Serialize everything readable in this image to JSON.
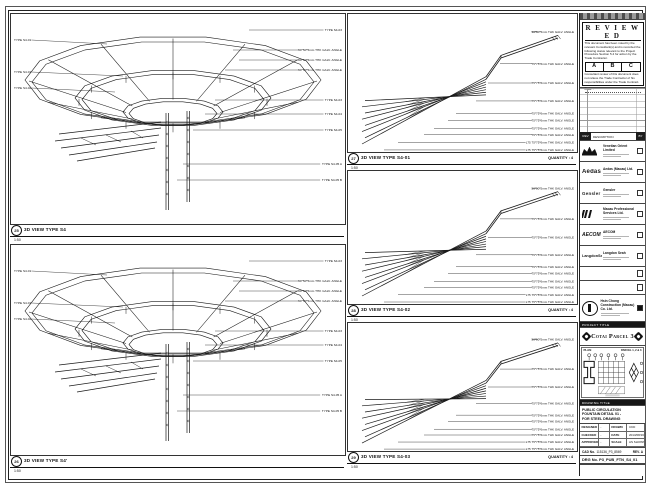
{
  "panels": {
    "left_top": {
      "num": "25",
      "title": "3D VIEW TYPE S4",
      "scale": "1:50",
      "labels_left": [
        "TYPE S4-01",
        "TYPE S4-01",
        "TYPE S4-02"
      ],
      "labels_right": [
        "TYPE S4-03",
        "50*50*5mm THK GALV. ANGLE",
        "50*50*5mm THK GALV. ANGLE",
        "50*50*5mm THK GALV. ANGLE",
        "TYPE S4-03",
        "TYPE S4-04",
        "TYPE S4-05",
        "TYPE S4-05 A",
        "TYPE S4-05 B"
      ]
    },
    "left_bottom": {
      "num": "26",
      "title": "3D VIEW TYPE S4'",
      "scale": "1:50",
      "labels_left": [
        "TYPE S4-01",
        "TYPE S4-01",
        "TYPE S4-02"
      ],
      "labels_right": [
        "TYPE S4-03",
        "50*50*5mm THK GALV. ANGLE",
        "50*50*5mm THK GALV. ANGLE",
        "50*50*5mm THK GALV. ANGLE",
        "TYPE S4-03",
        "TYPE S4-04",
        "TYPE S4-05",
        "TYPE S4-05 A",
        "TYPE S4-05 B"
      ]
    },
    "mid_top": {
      "num": "27",
      "title": "3D VIEW TYPE S4-01",
      "scale": "1:50",
      "quantity": "QUANTITY : 4",
      "labels": [
        "50*50*5mm THK GALV. ANGLE",
        "75*75*6mm THK GALV. ANGLE",
        "75*75*6mm THK GALV. ANGLE",
        "75*75*6mm THK GALV. ANGLE",
        "75*75*6mm THK GALV. ANGLE",
        "75*75*6mm THK GALV. ANGLE",
        "75*75*6mm THK GALV. ANGLE",
        "75*75*6mm THK GALV. ANGLE",
        "L75 75*75*6mm THK GALV. ANGLE",
        "L75 75*75*6mm THK GALV. ANGLE"
      ]
    },
    "mid_mid": {
      "num": "28",
      "title": "3D VIEW TYPE S4-02",
      "scale": "1:50",
      "quantity": "QUANTITY : 4",
      "labels": [
        "50*50*5mm THK GALV. ANGLE",
        "75*75*6mm THK GALV. ANGLE",
        "75*75*6mm THK GALV. ANGLE",
        "75*75*6mm THK GALV. ANGLE",
        "75*75*6mm THK GALV. ANGLE",
        "75*75*6mm THK GALV. ANGLE",
        "75*75*6mm THK GALV. ANGLE",
        "75*75*6mm THK GALV. ANGLE",
        "L75 75*75*6mm THK GALV. ANGLE",
        "L75 75*75*6mm THK GALV. ANGLE"
      ]
    },
    "mid_bottom": {
      "num": "29",
      "title": "3D VIEW TYPE S4-03",
      "scale": "1:50",
      "quantity": "QUANTITY : 4",
      "labels": [
        "50*50*5mm THK GALV. ANGLE",
        "75*75*6mm THK GALV. ANGLE",
        "75*75*6mm THK GALV. ANGLE",
        "75*75*6mm THK GALV. ANGLE",
        "75*75*6mm THK GALV. ANGLE",
        "75*75*6mm THK GALV. ANGLE",
        "75*75*6mm THK GALV. ANGLE",
        "75*75*6mm THK GALV. ANGLE",
        "L75 75*75*6mm THK GALV. ANGLE",
        "L75 75*75*6mm THK GALV. ANGLE"
      ]
    }
  },
  "titleblock": {
    "reviewed": {
      "title": "R E V I E W E D",
      "para1": "This document has been noted by the relevant Consultant(s) and is recorded the following status relevant to the Project Procedure Section 5.4 for action by the Trade Contractor.",
      "cols": [
        "A",
        "B",
        "C"
      ],
      "para2": "Consultant review of this document does not relieve the Trade Contractor of his responsibilities under the Trade Contract.",
      "date_label": "Date :"
    },
    "revision_footer": {
      "rev": "REV",
      "desc": "DESCRIPTION",
      "by": "BY"
    },
    "companies": [
      {
        "logo": "",
        "name": "Venetian Orient Limited"
      },
      {
        "logo": "Aedas",
        "name": "Aedas (Macau) Ltd."
      },
      {
        "logo": "Gensler",
        "name": "Gensler"
      },
      {
        "logo": "",
        "name": "Macau Professional Services Ltd."
      },
      {
        "logo": "AECOM",
        "name": "AECOM"
      },
      {
        "logo": "LangdonSeah",
        "name": "Langdon Seah"
      }
    ],
    "contractor": {
      "name": "Hsin Chong Construction (Macau) Co. Ltd."
    },
    "project_strip": "PROJECT TITLE",
    "project_title": "Cotai Parcel 3",
    "keyplan": {
      "plan": "PLAN",
      "parcel": "PARCEL 1, 2 & 3"
    },
    "drawing_strip": "DRAWING TITLE",
    "drawing_title_lines": [
      "PUBLIC CIRCULATION",
      "FOUNTAIN DETAIL 01 -",
      "FOR STEEL DRAWING"
    ],
    "fields": {
      "r1l1": "DESIGNED",
      "r1v1": "-",
      "r1l2": "DRAWN",
      "r1v2": "CKD",
      "r2l1": "CHECKED",
      "r2v1": "-",
      "r2l2": "DATE",
      "r2v2": "2013/08/16",
      "r3l1": "APPROVED",
      "r3v1": "-",
      "r3l2": "SCALE",
      "r3v2": "AS SHOWN"
    },
    "cad": {
      "label": "CAD No.",
      "value": "115136_P3_8569",
      "rev_label": "REV.",
      "rev": "A"
    },
    "drg": {
      "label": "DRG No.",
      "value": "P3_PUB_FTN_S4_01"
    }
  }
}
